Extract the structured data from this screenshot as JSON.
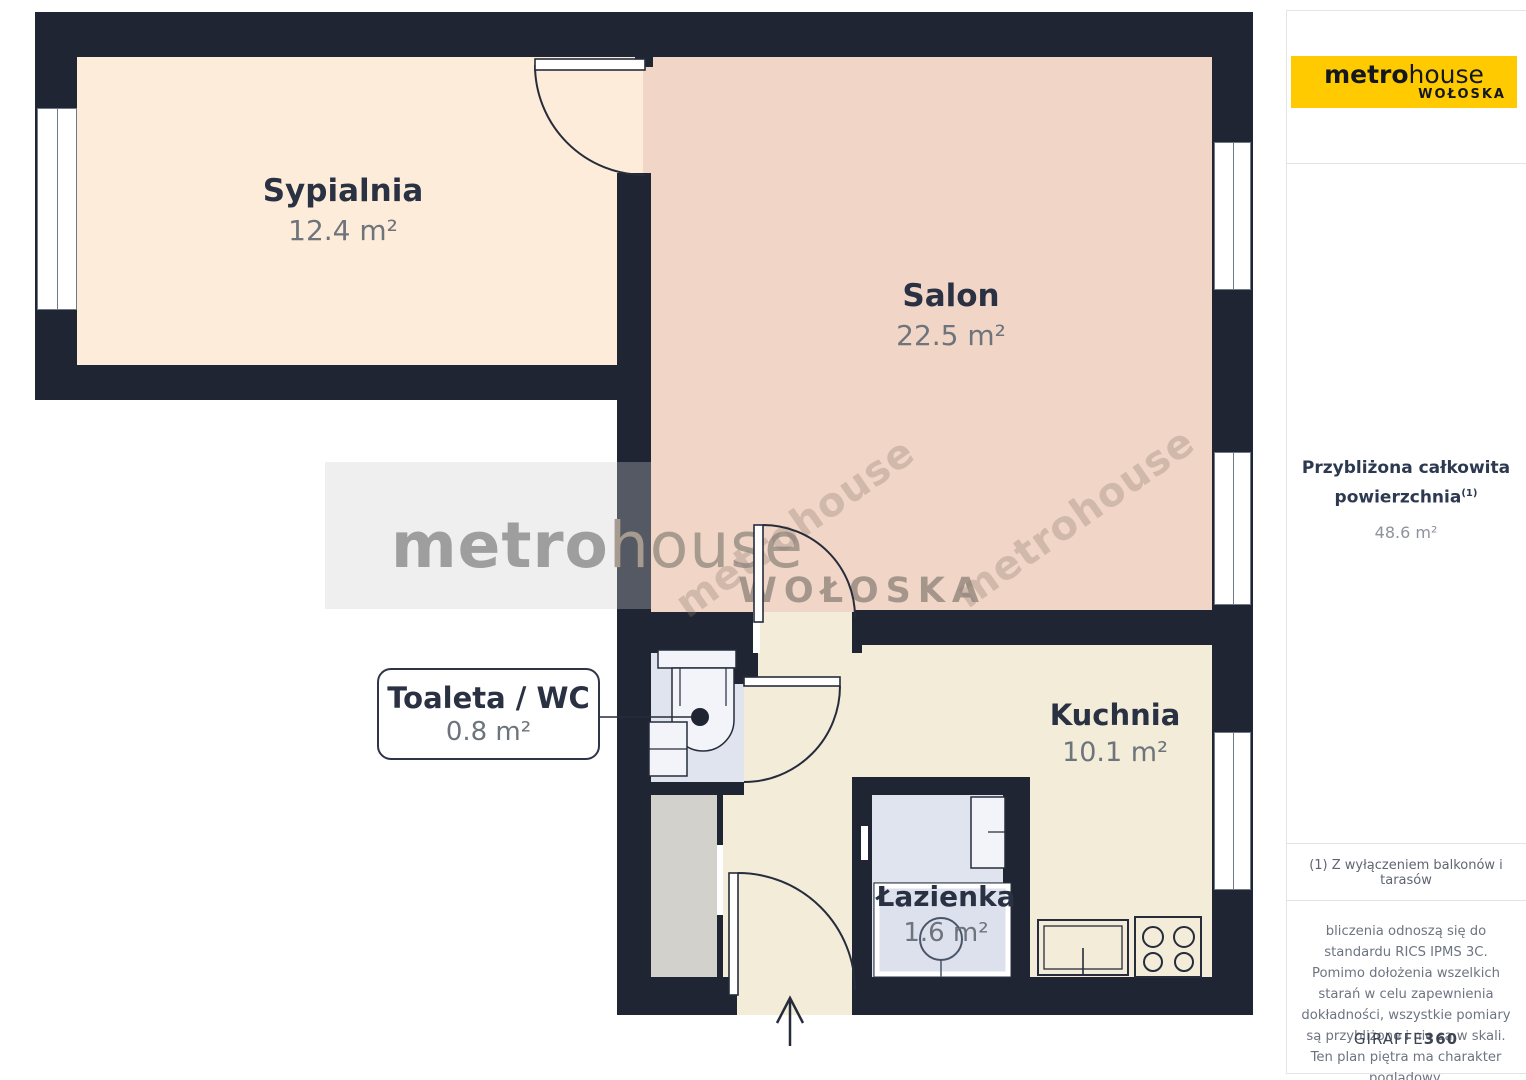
{
  "branding": {
    "logo_part1": "metro",
    "logo_part2": "house",
    "logo_sub": "WOŁOSKA",
    "logo_bg": "#ffcb00"
  },
  "watermark": {
    "part1": "metro",
    "part2": "house",
    "sub": "WOŁOSKA",
    "diag_text": "metrohouse"
  },
  "rooms": [
    {
      "id": "sypialnia",
      "name": "Sypialnia",
      "area": "12.4 m²"
    },
    {
      "id": "salon",
      "name": "Salon",
      "area": "22.5 m²"
    },
    {
      "id": "toaleta",
      "name": "Toaleta / WC",
      "area": "0.8 m²"
    },
    {
      "id": "kuchnia",
      "name": "Kuchnia",
      "area": "10.1 m²"
    },
    {
      "id": "lazienka",
      "name": "Łazienka",
      "area": "1.6 m²"
    }
  ],
  "sidebar": {
    "area_title_line1": "Przybliżona całkowita",
    "area_title_line2": "powierzchnia",
    "area_title_sup": "(1)",
    "area_value": "48.6 m²",
    "footnote": "(1) Z wyłączeniem balkonów i tarasów",
    "disclaimer": "bliczenia odnoszą się do standardu RICS IPMS 3C. Pomimo dołożenia wszelkich starań w celu zapewnienia dokładności, wszystkie pomiary są przybliżone i nie są w skali. Ten plan piętra ma charakter poglądowy.",
    "brand_footer_part1": "GIRAFFE",
    "brand_footer_part2": "360"
  },
  "colors": {
    "wall": "#1f2533",
    "bedroom_floor": "#fdecd9",
    "salon_floor": "#f1d5c6",
    "kitchen_floor": "#f2ecd9",
    "bathroom_floor": "#e0e4ef",
    "closet_floor": "#d3d1cc",
    "label_text": "#2a3142",
    "area_text": "#6e747c"
  }
}
